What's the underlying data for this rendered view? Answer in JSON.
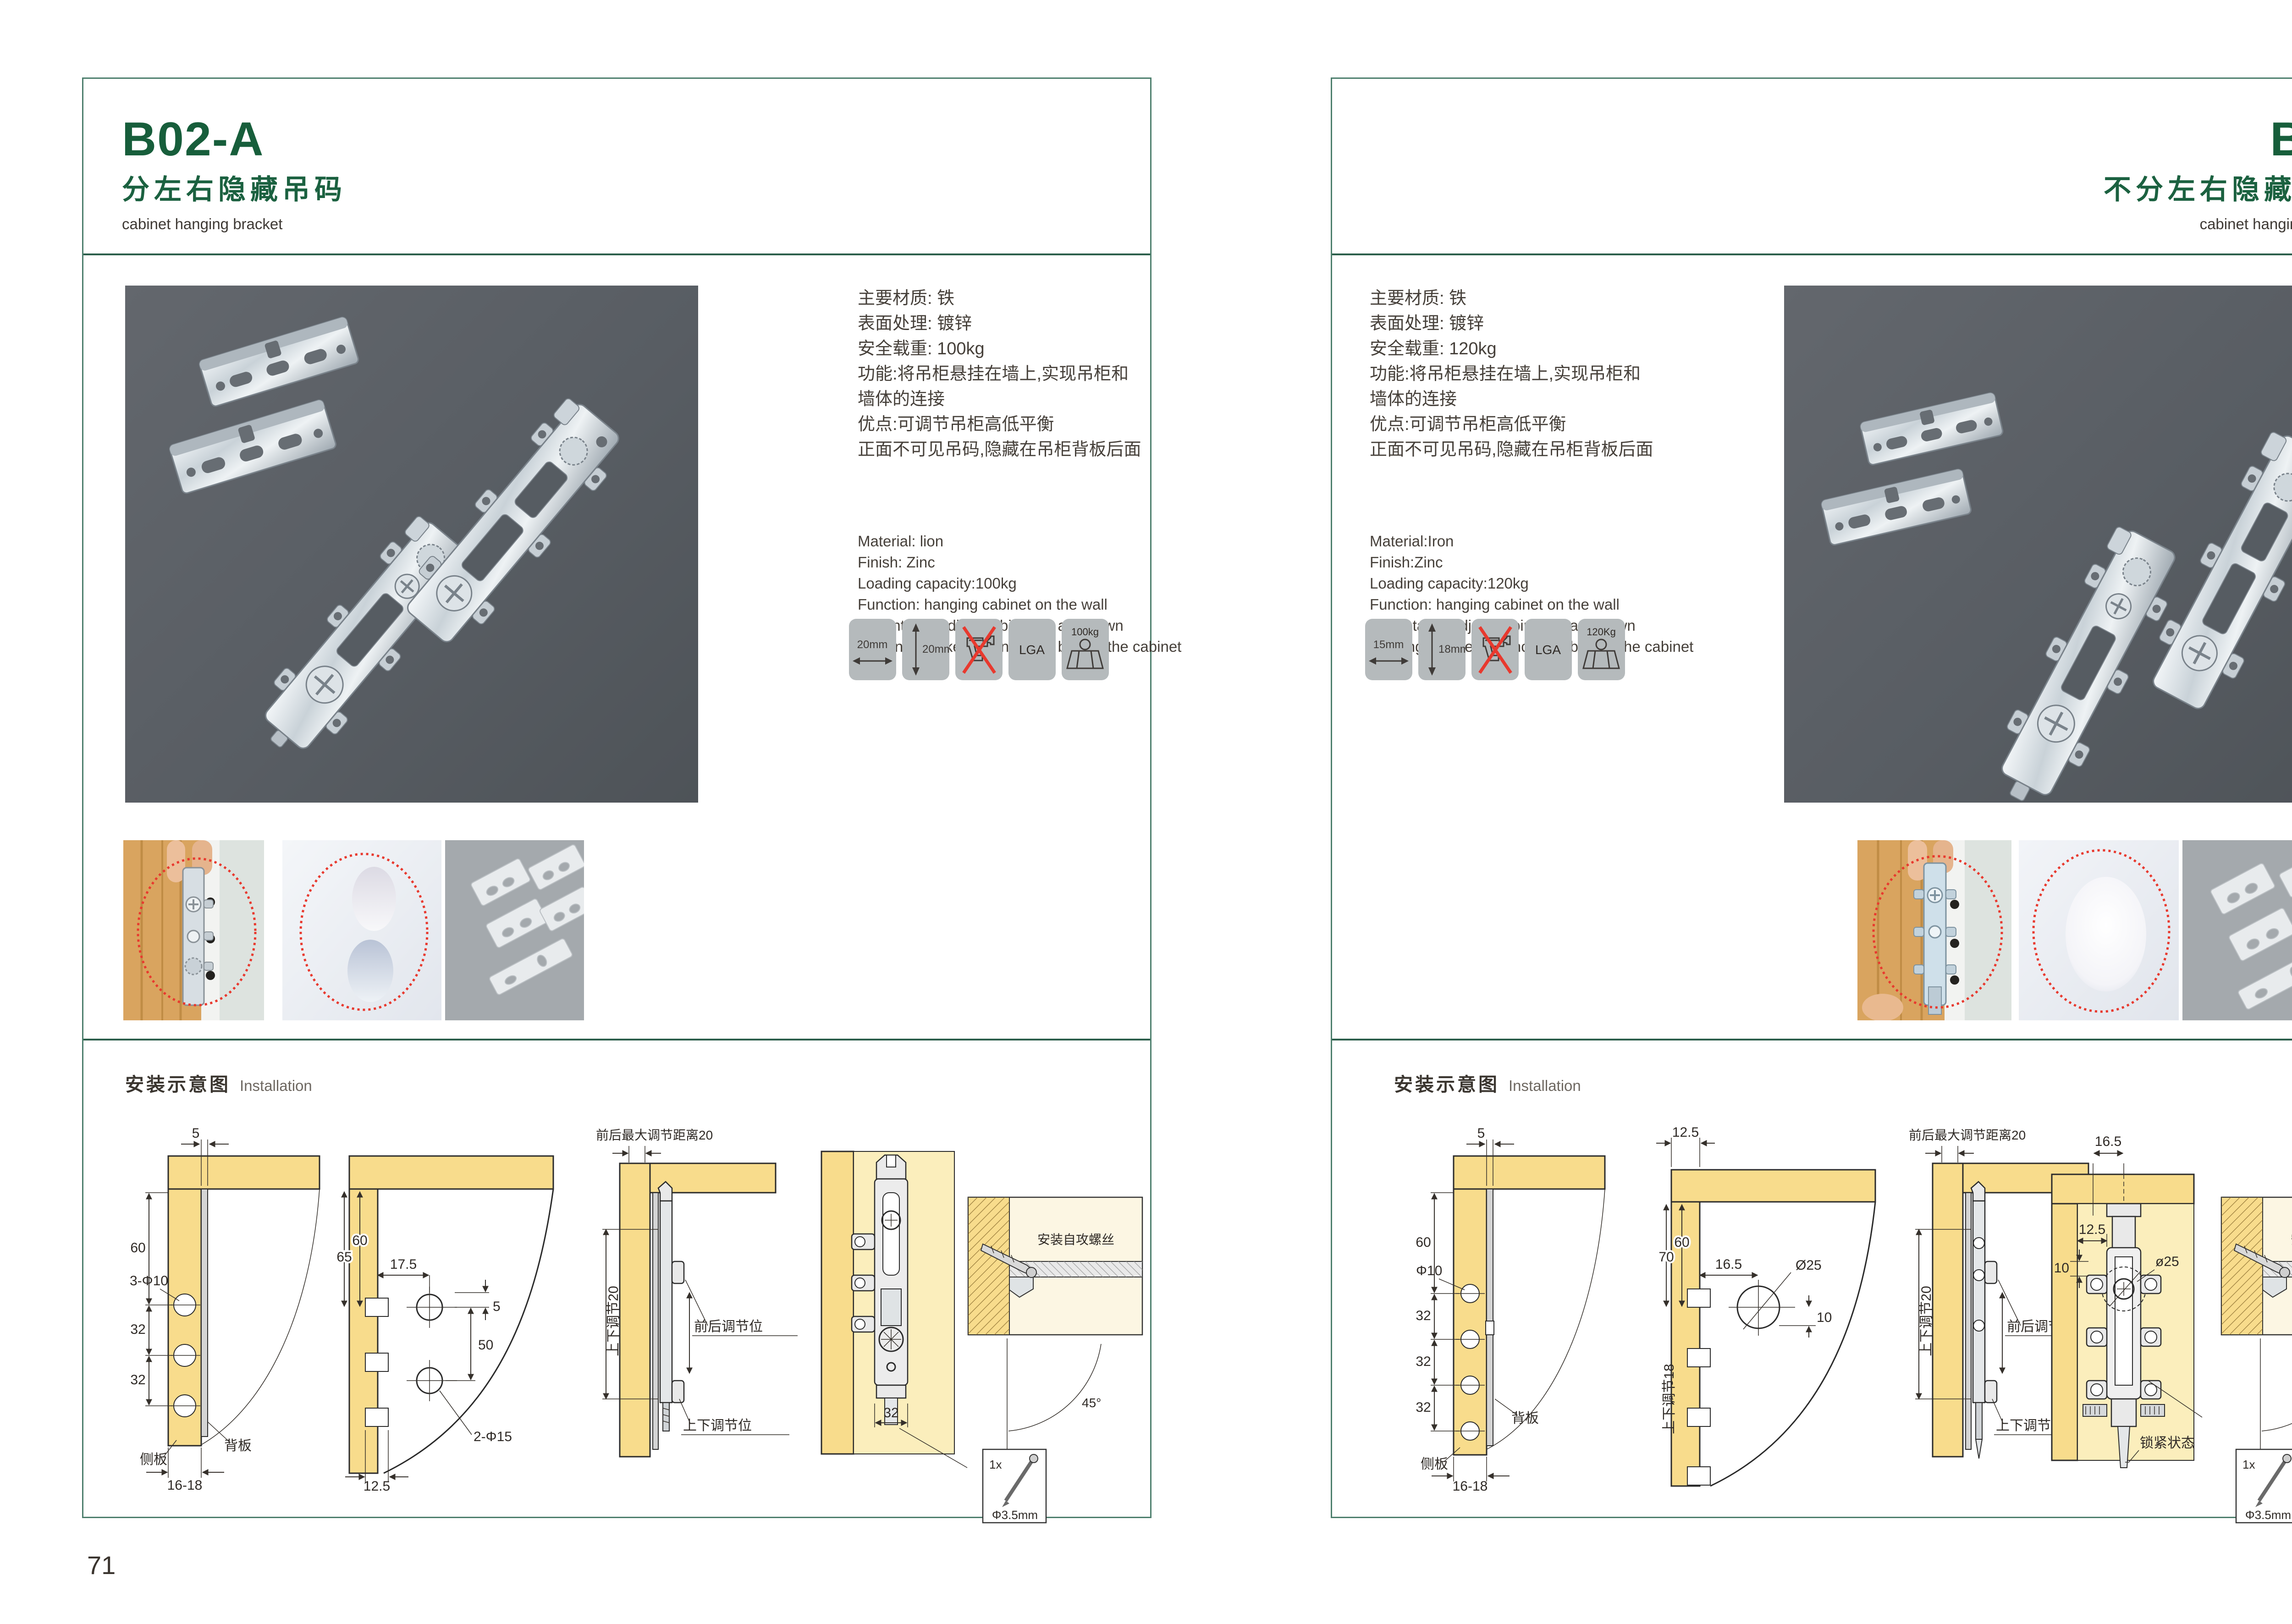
{
  "colors": {
    "title_green": "#175e3b",
    "frame_teal": "#4d7f6d",
    "rule_green": "#2d5f4c",
    "photo_bg": "#5b6065",
    "icon_bg": "#b5babc",
    "wood": "#f8dc8c",
    "accent_red": "#e8392e"
  },
  "pages": [
    {
      "code": "B02-A",
      "name_cn": "分左右隐藏吊码",
      "name_en": "cabinet hanging bracket",
      "page_number": "71",
      "specs_cn": [
        "主要材质: 铁",
        "表面处理: 镀锌",
        "安全载重: 100kg",
        "功能:将吊柜悬挂在墙上,实现吊柜和",
        "墙体的连接",
        "优点:可调节吊柜高低平衡",
        "正面不可见吊码,隐藏在吊柜背板后面"
      ],
      "specs_en": [
        "Material: lion",
        "Finish: Zinc",
        "Loading capacity:100kg",
        "Function: hanging cabinet on the wall",
        "Advantage: Adjust cabinet up and down",
        "hanging bracket is concealed behind the cabinet"
      ],
      "icons": {
        "width_label": "20mm",
        "height_label": "20mm",
        "cert_label": "LGA",
        "load_label": "100kg"
      },
      "install_title_cn": "安装示意图",
      "install_title_en": "Installation",
      "d1": {
        "dim_top": "5",
        "dim_60": "60",
        "hole_label": "3-Φ10",
        "dim_32a": "32",
        "dim_32b": "32",
        "side_panel": "侧板",
        "back_panel": "背板",
        "dim_bottom": "16-18"
      },
      "d2": {
        "dim_17_5": "17.5",
        "dim_65": "65",
        "dim_60": "60",
        "dim_5": "5",
        "dim_50": "50",
        "hole_label": "2-Φ15",
        "dim_12_5": "12.5"
      },
      "d3": {
        "top_label": "前后最大调节距离20",
        "side_label": "上下调节20",
        "front_back": "前后调节位",
        "up_down": "上下调节位"
      },
      "d4": {
        "dim_32": "32"
      },
      "detail": {
        "screw_label": "安装自攻螺丝",
        "angle": "45°",
        "qty": "1x",
        "screw_dia": "Φ3.5mm"
      }
    },
    {
      "code": "B03",
      "name_cn": "不分左右隐藏吊码",
      "name_en": "cabinet hanging bracket",
      "page_number": "72",
      "specs_cn": [
        "主要材质: 铁",
        "表面处理: 镀锌",
        "安全载重: 120kg",
        "功能:将吊柜悬挂在墙上,实现吊柜和",
        "墙体的连接",
        "优点:可调节吊柜高低平衡",
        "正面不可见吊码,隐藏在吊柜背板后面"
      ],
      "specs_en": [
        "Material:Iron",
        "Finish:Zinc",
        "Loading capacity:120kg",
        "Function: hanging cabinet on the wall",
        "Advantage: Adjust cabinet up and down",
        "hanging bracket is concealed behind the cabinet"
      ],
      "icons": {
        "width_label": "15mm",
        "height_label": "18mm",
        "cert_label": "LGA",
        "load_label": "120Kg"
      },
      "install_title_cn": "安装示意图",
      "install_title_en": "Installation",
      "d1": {
        "dim_top": "5",
        "dim_60": "60",
        "hole_label": "Φ10",
        "dim_32a": "32",
        "dim_32b": "32",
        "dim_32c": "32",
        "side_panel": "侧板",
        "back_panel": "背板",
        "dim_bottom": "16-18"
      },
      "d2": {
        "dim_12_5": "12.5",
        "dim_16_5": "16.5",
        "dim_70": "70",
        "dim_60": "60",
        "hole_label": "Ø25",
        "dim_10": "10",
        "side_label": "上下调节18"
      },
      "d3": {
        "top_label": "前后最大调节距离20",
        "side_label": "上下调节20",
        "front_back": "前后调节位",
        "up_down": "上下调节位"
      },
      "d4": {
        "dim_16_5": "16.5",
        "dim_12_5": "12.5",
        "dim_10": "10",
        "hole_label": "ø25",
        "lock_label": "锁紧状态"
      },
      "detail": {
        "screw_label": "安装自攻螺丝",
        "angle": "45°",
        "qty": "1x",
        "screw_dia": "Φ3.5mm"
      }
    }
  ]
}
